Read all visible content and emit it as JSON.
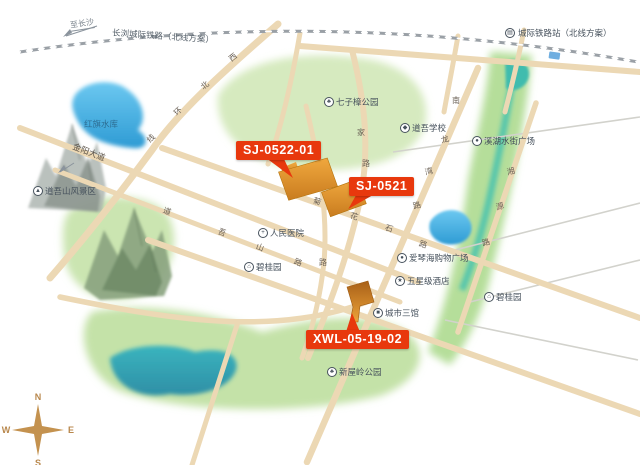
{
  "colors": {
    "accent_red": "#e8380d",
    "parcel_orange": "#e09134",
    "road_tan": "#ecd8b4",
    "water_blue": "#3aa5dc",
    "park_green": "#cfe7b4"
  },
  "railway": {
    "to_label": "至长沙",
    "line_label": "长浏城际铁路（北线方案）",
    "station_label": "城际铁路站（北线方案）",
    "station_icon": "▤"
  },
  "jinyang_avenue": {
    "label": "金阳大道",
    "arrow": "↙"
  },
  "parcels": [
    {
      "id": "SJ-0522-01"
    },
    {
      "id": "SJ-0521"
    },
    {
      "id": "XWL-05-19-02"
    }
  ],
  "compass": {
    "n": "N",
    "e": "E",
    "s": "S",
    "w": "W"
  },
  "pois": [
    {
      "name": "hongqi-reservoir-label",
      "label": "红旗水库",
      "icon": "",
      "x": 84,
      "y": 124,
      "water": true
    },
    {
      "name": "daowushan-scenic-area",
      "label": "道吾山风景区",
      "icon": "▲",
      "x": 33,
      "y": 191
    },
    {
      "name": "qizizhang-park",
      "label": "七子樟公园",
      "icon": "♣",
      "x": 324,
      "y": 102
    },
    {
      "name": "daowu-school",
      "label": "道吾学校",
      "icon": "◆",
      "x": 400,
      "y": 128
    },
    {
      "name": "xihu-water-street-plaza",
      "label": "溪湖水街广场",
      "icon": "●",
      "x": 472,
      "y": 141
    },
    {
      "name": "peoples-hospital",
      "label": "人民医院",
      "icon": "+",
      "x": 258,
      "y": 233
    },
    {
      "name": "biguiyuan-west",
      "label": "碧桂园",
      "icon": "⌂",
      "x": 244,
      "y": 267
    },
    {
      "name": "aiqinhai-shopping-plaza",
      "label": "爱琴海购物广场",
      "icon": "●",
      "x": 397,
      "y": 258
    },
    {
      "name": "five-star-hotel",
      "label": "五星级酒店",
      "icon": "★",
      "x": 395,
      "y": 281
    },
    {
      "name": "city-three-halls",
      "label": "城市三馆",
      "icon": "■",
      "x": 373,
      "y": 313
    },
    {
      "name": "biguiyuan-east",
      "label": "碧桂园",
      "icon": "⌂",
      "x": 484,
      "y": 297
    },
    {
      "name": "xinwuling-park",
      "label": "新屋岭公园",
      "icon": "♣",
      "x": 327,
      "y": 372
    }
  ],
  "road_names": [
    {
      "name": "xibei-ring-road",
      "chars": [
        {
          "c": "西",
          "x": 229,
          "y": 52,
          "r": -38
        },
        {
          "c": "北",
          "x": 201,
          "y": 80,
          "r": -38
        },
        {
          "c": "环",
          "x": 174,
          "y": 106,
          "r": -42
        },
        {
          "c": "线",
          "x": 147,
          "y": 133,
          "r": -45
        }
      ]
    },
    {
      "name": "juhuashi-road",
      "chars": [
        {
          "c": "菊",
          "x": 313,
          "y": 196,
          "r": 17
        },
        {
          "c": "花",
          "x": 350,
          "y": 211,
          "r": 17
        },
        {
          "c": "石",
          "x": 385,
          "y": 223,
          "r": 17
        },
        {
          "c": "路",
          "x": 419,
          "y": 239,
          "r": 17
        }
      ]
    },
    {
      "name": "daowushan-road",
      "chars": [
        {
          "c": "道",
          "x": 163,
          "y": 206,
          "r": 20
        },
        {
          "c": "吾",
          "x": 218,
          "y": 227,
          "r": 20
        },
        {
          "c": "山",
          "x": 256,
          "y": 242,
          "r": 20
        },
        {
          "c": "路",
          "x": 294,
          "y": 257,
          "r": 20
        }
      ]
    },
    {
      "name": "jia-road",
      "chars": [
        {
          "c": "家",
          "x": 357,
          "y": 127,
          "r": 0
        },
        {
          "c": "路",
          "x": 362,
          "y": 158,
          "r": 0
        }
      ]
    },
    {
      "name": "longwan-road",
      "chars": [
        {
          "c": "龙",
          "x": 441,
          "y": 134,
          "r": -15
        },
        {
          "c": "湾",
          "x": 425,
          "y": 166,
          "r": -15
        },
        {
          "c": "路",
          "x": 413,
          "y": 200,
          "r": -15
        }
      ]
    },
    {
      "name": "nan-road",
      "chars": [
        {
          "c": "南",
          "x": 452,
          "y": 95,
          "r": 0
        }
      ]
    },
    {
      "name": "xiangyuan-road",
      "chars": [
        {
          "c": "湘",
          "x": 507,
          "y": 166,
          "r": -15
        },
        {
          "c": "源",
          "x": 496,
          "y": 201,
          "r": -15
        },
        {
          "c": "路",
          "x": 482,
          "y": 237,
          "r": -15
        }
      ]
    },
    {
      "name": "lu-vertical",
      "chars": [
        {
          "c": "路",
          "x": 319,
          "y": 257,
          "r": 0
        }
      ]
    }
  ]
}
